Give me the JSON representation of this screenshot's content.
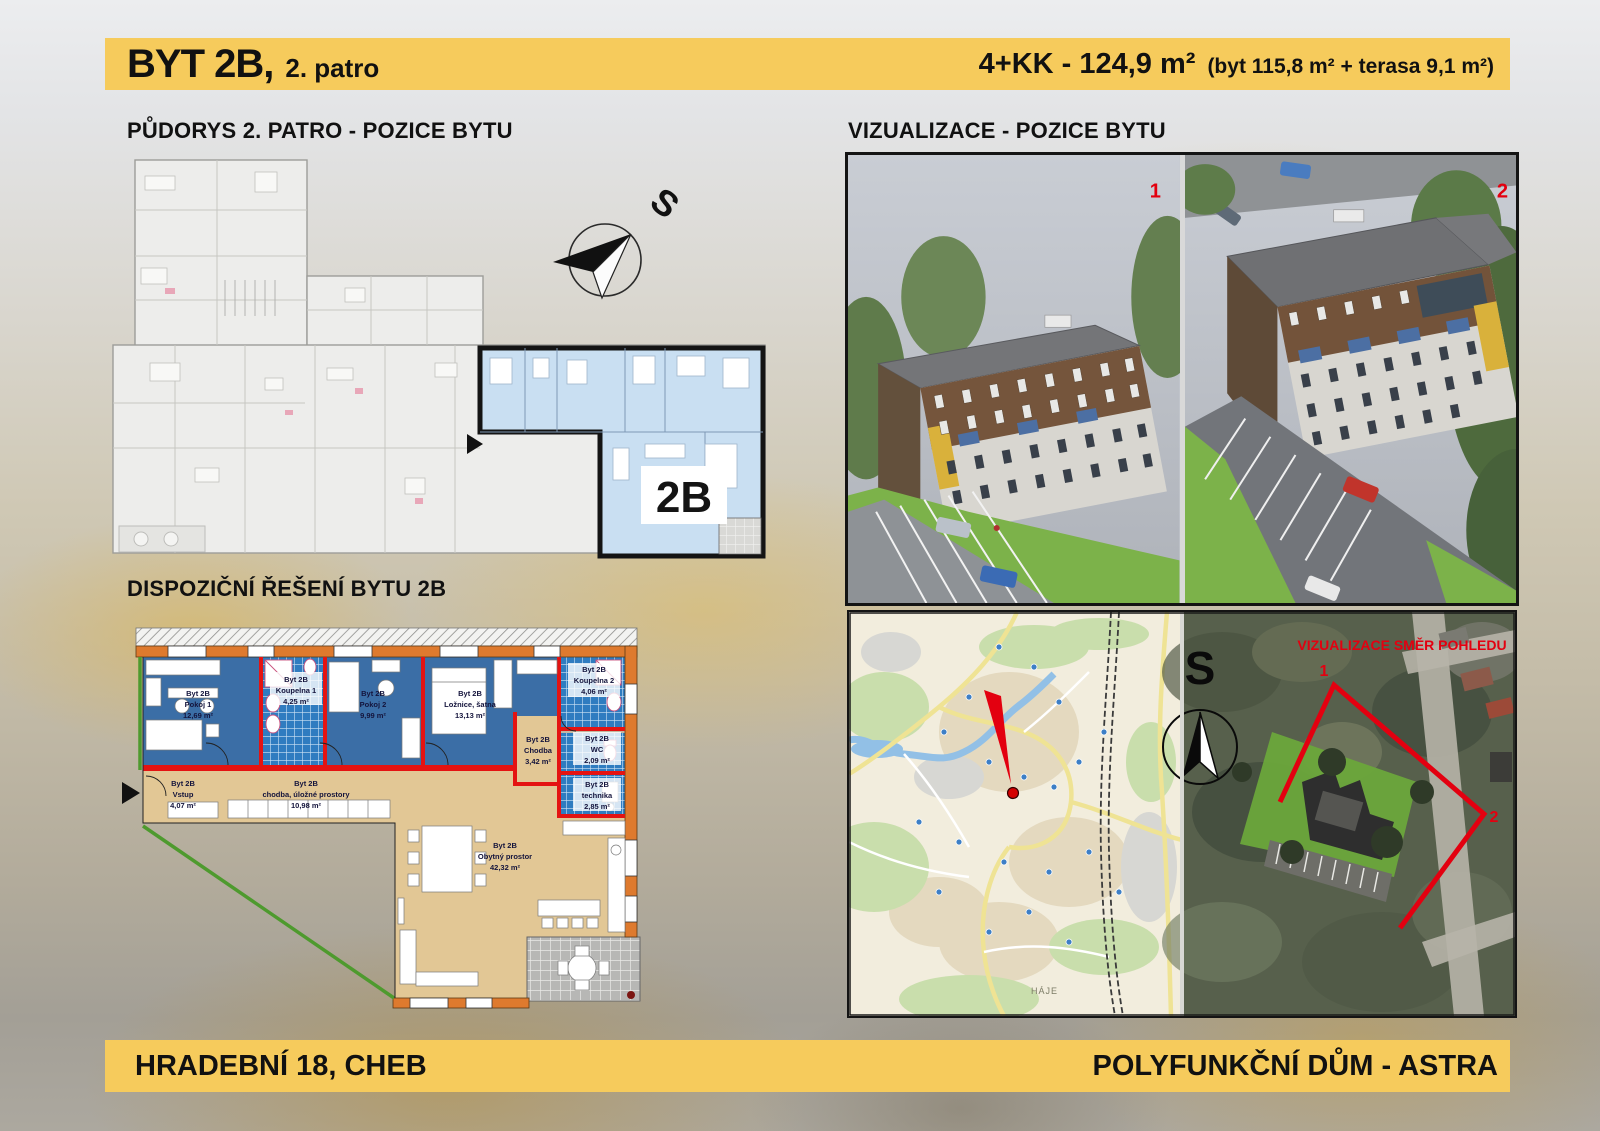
{
  "header": {
    "title": "BYT 2B,",
    "floor": "2. patro",
    "spec": "4+KK  -  124,9 m²",
    "spec_detail": "(byt 115,8 m² + terasa 9,1 m²)"
  },
  "sections": {
    "pudorys": {
      "title": "PŮDORYS 2. PATRO - POZICE BYTU",
      "unit_label": "2B",
      "compass_label": "S"
    },
    "vizualizace": {
      "title": "VIZUALIZACE - POZICE BYTU",
      "view1_label": "1",
      "view2_label": "2"
    },
    "dispozice": {
      "title": "DISPOZIČNÍ ŘEŠENÍ BYTU 2B",
      "rooms": [
        {
          "unit": "Byt 2B",
          "name": "Pokoj 1",
          "area": "12,69 m²"
        },
        {
          "unit": "Byt 2B",
          "name": "Koupelna 1",
          "area": "4,25 m²"
        },
        {
          "unit": "Byt 2B",
          "name": "Pokoj 2",
          "area": "9,99 m²"
        },
        {
          "unit": "Byt 2B",
          "name": "Ložnice, šatna",
          "area": "13,13 m²"
        },
        {
          "unit": "Byt 2B",
          "name": "Koupelna 2",
          "area": "4,06 m²"
        },
        {
          "unit": "Byt 2B",
          "name": "WC",
          "area": "2,09 m²"
        },
        {
          "unit": "Byt 2B",
          "name": "Chodba",
          "area": "3,42 m²"
        },
        {
          "unit": "Byt 2B",
          "name": "technika",
          "area": "2,85 m²"
        },
        {
          "unit": "Byt 2B",
          "name": "Vstup",
          "area": "4,07 m²"
        },
        {
          "unit": "Byt 2B",
          "name": "chodba, úložné prostory",
          "area": "10,98 m²"
        },
        {
          "unit": "Byt 2B",
          "name": "Obytný prostor",
          "area": "42,32 m²"
        }
      ]
    },
    "situace": {
      "title": "SITUACE",
      "overlay_title": "VIZUALIZACE SMĚR POHLEDU",
      "map_place_label": "HÁJE",
      "compass_label": "S",
      "view1_label": "1",
      "view2_label": "2"
    }
  },
  "footer": {
    "left": "HRADEBNÍ 18, CHEB",
    "right": "POLYFUNKČNÍ DŮM - ASTRA"
  },
  "colors": {
    "accent_yellow": "#F6CB5C",
    "highlight_blue": "#C9DFF2",
    "room_blue": "#3B6EA6",
    "tile_blue": "#2F7CC0",
    "floor_tan": "#E2C795",
    "wall_orange": "#DE7A2E",
    "wall_red": "#E41312",
    "boundary_green": "#4E9A2E",
    "marker_red": "#E3000F"
  }
}
